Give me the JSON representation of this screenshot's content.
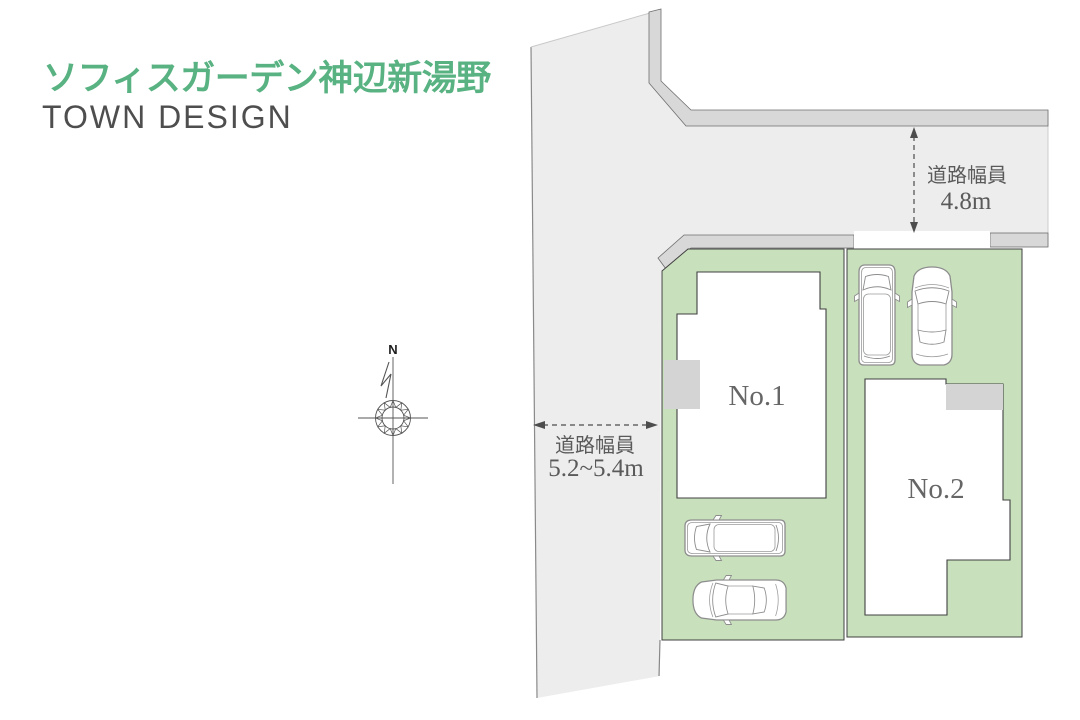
{
  "header": {
    "title": "ソフィスガーデン神辺新湯野",
    "subtitle": "TOWN DESIGN"
  },
  "plan": {
    "compass": {
      "north_label": "N"
    },
    "lots": [
      {
        "id": "lot-1",
        "label": "No.1"
      },
      {
        "id": "lot-2",
        "label": "No.2"
      }
    ],
    "road_labels": [
      {
        "caption": "道路幅員",
        "width": "4.8m",
        "arrow": "vertical-double-dashed"
      },
      {
        "caption": "道路幅員",
        "width": "5.2~5.4m",
        "arrow": "horizontal-double-dashed"
      }
    ],
    "colors": {
      "title_green": "#59b282",
      "subtitle_gray": "#4e4e4e",
      "lot_green": "#c9e0bd",
      "road_gray": "#ededed",
      "curb_gray": "#d8d8d8",
      "pad_gray": "#d4d4d4",
      "outline_dark": "#404040",
      "label_gray": "#5a5a5a"
    }
  }
}
